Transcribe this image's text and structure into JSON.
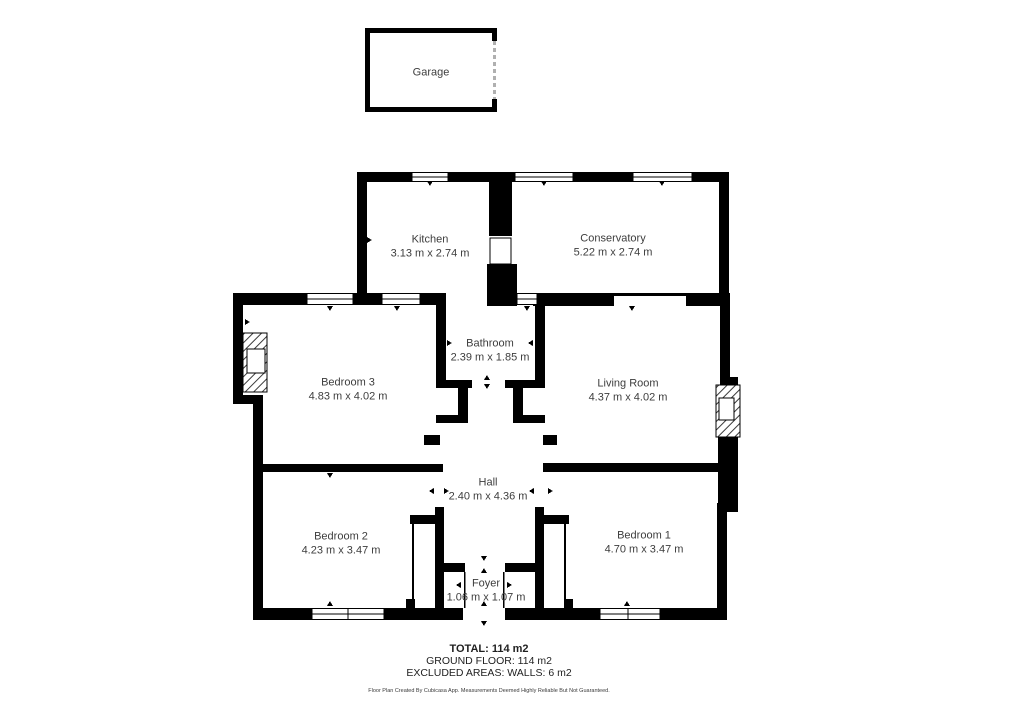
{
  "rooms": {
    "garage": {
      "name": "Garage",
      "dims": ""
    },
    "kitchen": {
      "name": "Kitchen",
      "dims": "3.13 m x 2.74 m"
    },
    "conservatory": {
      "name": "Conservatory",
      "dims": "5.22 m x 2.74 m"
    },
    "bathroom": {
      "name": "Bathroom",
      "dims": "2.39 m x 1.85 m"
    },
    "bedroom3": {
      "name": "Bedroom 3",
      "dims": "4.83 m x 4.02 m"
    },
    "living_room": {
      "name": "Living Room",
      "dims": "4.37 m x 4.02 m"
    },
    "hall": {
      "name": "Hall",
      "dims": "2.40 m x 4.36 m"
    },
    "bedroom2": {
      "name": "Bedroom 2",
      "dims": "4.23 m x 3.47 m"
    },
    "bedroom1": {
      "name": "Bedroom 1",
      "dims": "4.70 m x 3.47 m"
    },
    "foyer": {
      "name": "Foyer",
      "dims": "1.06 m x 1.07 m"
    }
  },
  "summary": {
    "total": "TOTAL: 114 m2",
    "ground_floor": "GROUND FLOOR: 114 m2",
    "excluded": "EXCLUDED AREAS: WALLS: 6 m2"
  },
  "disclaimer": "Floor Plan Created By Cubicasa App. Measurements Deemed Highly Reliable But Not Guaranteed.",
  "colors": {
    "wall": "#000000",
    "text": "#3d3d3d",
    "garage_door": "#b0b0b0"
  }
}
